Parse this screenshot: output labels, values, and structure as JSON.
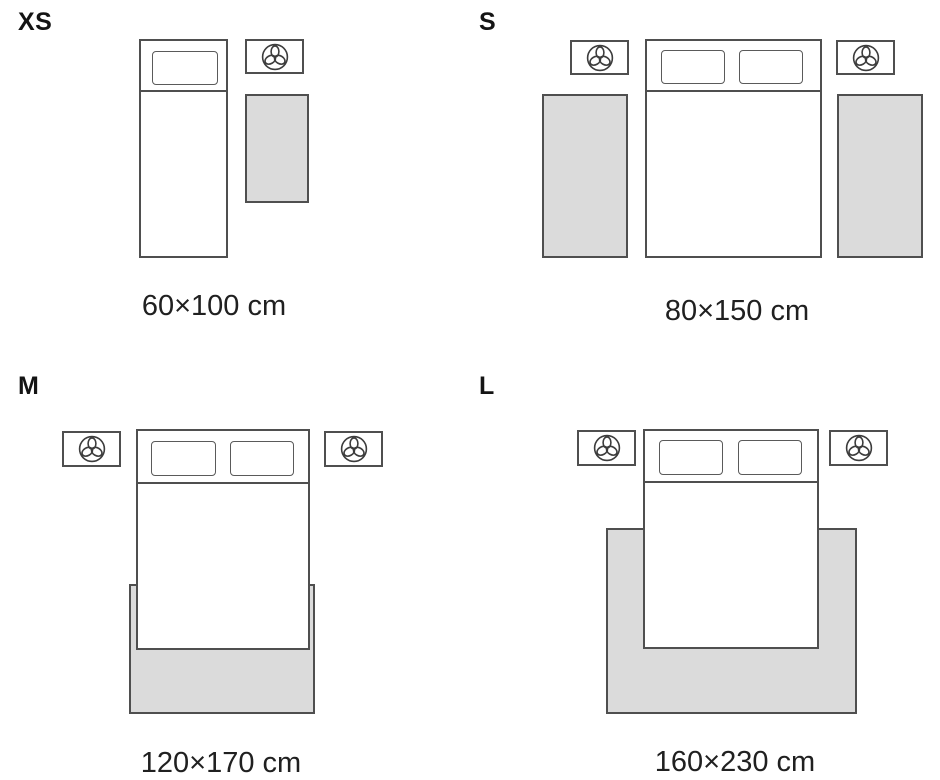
{
  "diagram": {
    "type": "rug-size-guide",
    "unit": "cm"
  },
  "sizes": [
    {
      "code": "XS",
      "dimensions": "60×100 cm"
    },
    {
      "code": "S",
      "dimensions": "80×150 cm"
    },
    {
      "code": "M",
      "dimensions": "120×170 cm"
    },
    {
      "code": "L",
      "dimensions": "160×230 cm"
    }
  ],
  "icons": {
    "nightstand": "plant-top-view-icon"
  },
  "colors": {
    "background": "#ffffff",
    "outline": "#4f4f4f",
    "rug_fill": "#dbdbdb",
    "bed_fill": "#ffffff",
    "text": "#202020"
  }
}
